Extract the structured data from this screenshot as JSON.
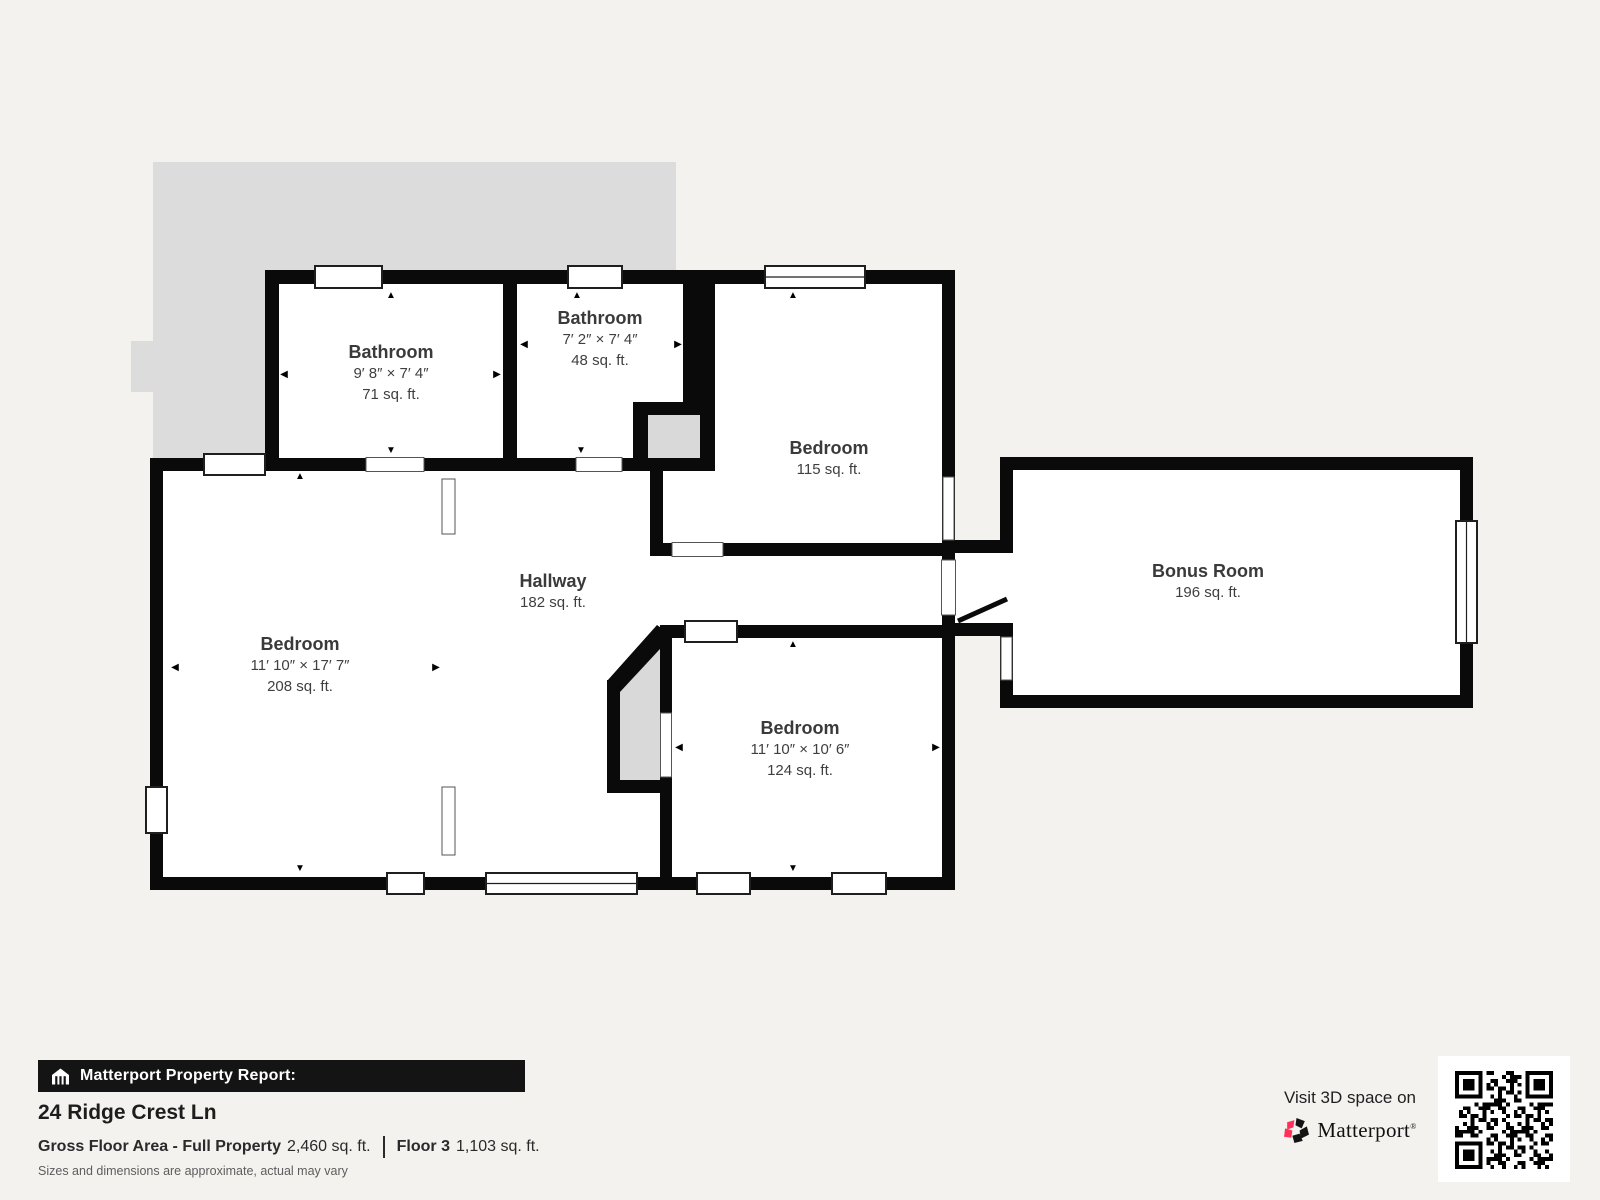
{
  "plan": {
    "rooms": [
      {
        "key": "bathroom-1",
        "name": "Bathroom",
        "dims": "9′ 8″ × 7′ 4″",
        "area": "71 sq. ft."
      },
      {
        "key": "bathroom-2",
        "name": "Bathroom",
        "dims": "7′ 2″ × 7′ 4″",
        "area": "48 sq. ft."
      },
      {
        "key": "bedroom-top",
        "name": "Bedroom",
        "dims": "",
        "area": "115 sq. ft."
      },
      {
        "key": "bedroom-left",
        "name": "Bedroom",
        "dims": "11′ 10″ × 17′ 7″",
        "area": "208 sq. ft."
      },
      {
        "key": "hallway",
        "name": "Hallway",
        "dims": "",
        "area": "182 sq. ft."
      },
      {
        "key": "bedroom-bottom",
        "name": "Bedroom",
        "dims": "11′ 10″ × 10′ 6″",
        "area": "124 sq. ft."
      },
      {
        "key": "bonus-room",
        "name": "Bonus Room",
        "dims": "",
        "area": "196 sq. ft."
      }
    ]
  },
  "report": {
    "banner": "Matterport Property Report:",
    "address": "24 Ridge Crest Ln",
    "gross_label": "Gross Floor Area - Full Property",
    "gross_value": "2,460 sq. ft.",
    "floor_label": "Floor 3",
    "floor_value": "1,103 sq. ft.",
    "disclaimer": "Sizes and dimensions are approximate, actual may vary"
  },
  "cta": {
    "text": "Visit 3D space on",
    "brand": "Matterport",
    "trademark": "®"
  },
  "icons": {
    "arrow_left": "◀",
    "arrow_right": "▶",
    "arrow_up": "▲",
    "arrow_down": "▼"
  },
  "colors": {
    "background": "#f4f2ef",
    "wall": "#0a0a0a",
    "roof_outline_gray": "#dcdcdc",
    "stair_gray": "#d9d9d9",
    "banner_bg": "#141414",
    "brand_red": "#ff3158"
  }
}
